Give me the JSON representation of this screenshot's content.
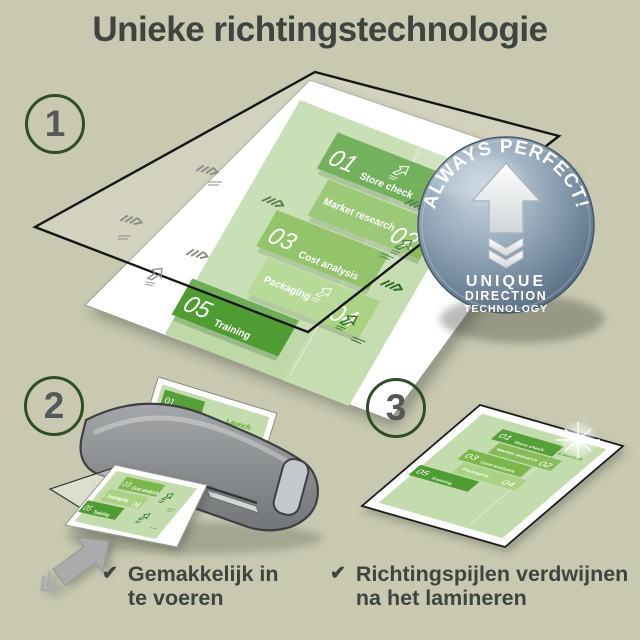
{
  "title": "Unieke richtingstechnologie",
  "steps": [
    {
      "number": "1"
    },
    {
      "number": "2"
    },
    {
      "number": "3"
    }
  ],
  "badge": {
    "arc_text": "ALWAYS PERFECT!",
    "line1": "UNIQUE",
    "line2": "DIRECTION",
    "line3": "TECHNOLOGY"
  },
  "plan_document": {
    "launch_label": "Launch",
    "tiles": [
      {
        "num": "01",
        "label": "Store check"
      },
      {
        "num": "02",
        "label": "Market research"
      },
      {
        "num": "03",
        "label": "Cost analysis"
      },
      {
        "num": "04",
        "label": "Packaging"
      },
      {
        "num": "05",
        "label": "Training"
      }
    ]
  },
  "bullets": [
    {
      "check": "✔",
      "line1": "Gemakkelijk in",
      "line2": "te voeren"
    },
    {
      "check": "✔",
      "line1": "Richtingspijlen verdwijnen",
      "line2": "na het lamineren"
    }
  ],
  "colors": {
    "background": "#c9c9b1",
    "text_dark": "#3e4440",
    "circle_border": "#2e4d28",
    "green_dark": "#56a03a",
    "green_mid": "#86bd5a",
    "green_light": "#a9d283",
    "doc_bg": "#bed8a7",
    "badge_blue": "#8ba0b3",
    "machine_gray": "#8a8c8e"
  }
}
